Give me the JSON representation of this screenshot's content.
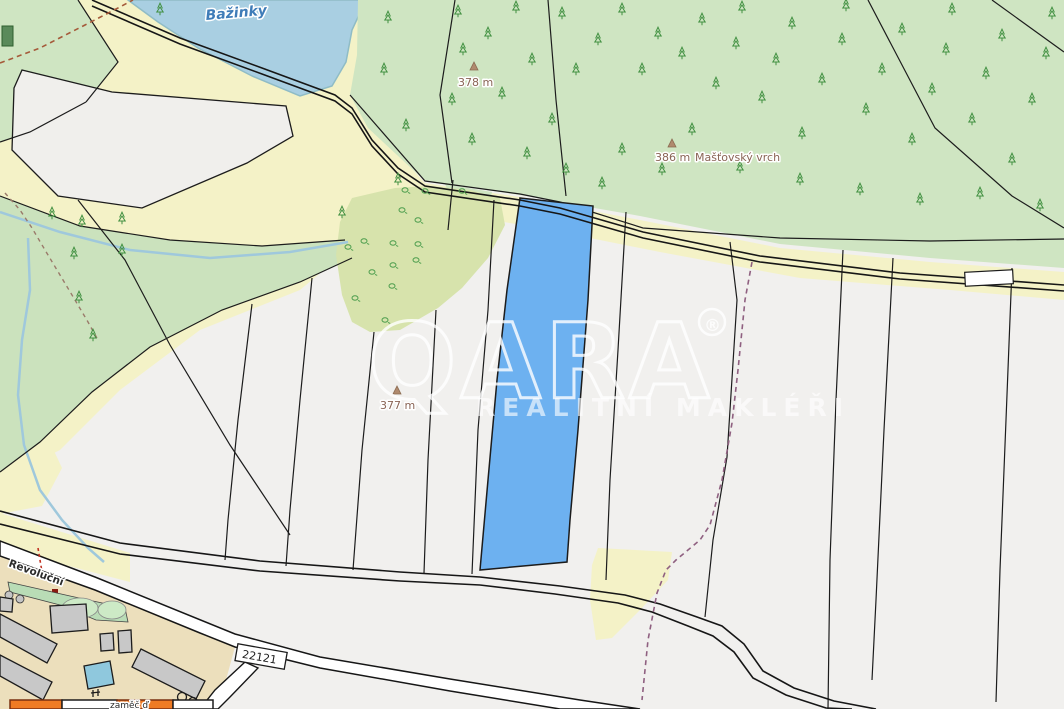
{
  "watermark": {
    "brand": "QARA",
    "registered": "®",
    "tagline": "REALITNÍ MAKLÉŘI"
  },
  "labels": {
    "water_name": "Bažinky",
    "street_name": "Revoluční",
    "road_number": "22121",
    "bottom_partial": "zaměč ď",
    "peak_378": "378 m",
    "peak_386": "386 m",
    "peak_386_name": "Mašťovský vrch",
    "peak_377": "377 m"
  },
  "colors": {
    "parcel_white": "#f1f0ee",
    "field_yellow": "#f4f2c7",
    "urban_tan": "#ecdfbc",
    "forest_green": "#cfe5c2",
    "scrub_olive": "#d7e3ac",
    "water_blue": "#a9cfe2",
    "highlight_parcel_blue": "#6db1f0",
    "building_grey": "#c8c8c8",
    "subject_orange": "#ef7b24",
    "boundary_black": "#1c1c1c",
    "cadastral_dash_mauve": "#8f6080",
    "path_dash_brown": "#a55a3a",
    "peak_label_brown": "#8a6455",
    "water_label_blue": "#3f7cb8"
  },
  "map": {
    "trees": [
      [
        388,
        20
      ],
      [
        384,
        72
      ],
      [
        406,
        128
      ],
      [
        398,
        182
      ],
      [
        458,
        14
      ],
      [
        463,
        52
      ],
      [
        452,
        102
      ],
      [
        472,
        142
      ],
      [
        488,
        36
      ],
      [
        516,
        10
      ],
      [
        502,
        96
      ],
      [
        532,
        62
      ],
      [
        562,
        16
      ],
      [
        576,
        72
      ],
      [
        552,
        122
      ],
      [
        598,
        42
      ],
      [
        622,
        12
      ],
      [
        642,
        72
      ],
      [
        658,
        36
      ],
      [
        682,
        56
      ],
      [
        702,
        22
      ],
      [
        716,
        86
      ],
      [
        736,
        46
      ],
      [
        742,
        10
      ],
      [
        762,
        100
      ],
      [
        776,
        62
      ],
      [
        792,
        26
      ],
      [
        802,
        136
      ],
      [
        822,
        82
      ],
      [
        842,
        42
      ],
      [
        846,
        8
      ],
      [
        866,
        112
      ],
      [
        882,
        72
      ],
      [
        902,
        32
      ],
      [
        912,
        142
      ],
      [
        932,
        92
      ],
      [
        946,
        52
      ],
      [
        952,
        12
      ],
      [
        972,
        122
      ],
      [
        986,
        76
      ],
      [
        1002,
        38
      ],
      [
        1012,
        162
      ],
      [
        1032,
        102
      ],
      [
        1046,
        56
      ],
      [
        1052,
        16
      ],
      [
        622,
        152
      ],
      [
        602,
        186
      ],
      [
        662,
        172
      ],
      [
        692,
        132
      ],
      [
        566,
        172
      ],
      [
        527,
        156
      ],
      [
        740,
        170
      ],
      [
        800,
        182
      ],
      [
        860,
        192
      ],
      [
        920,
        202
      ],
      [
        980,
        196
      ],
      [
        1040,
        208
      ],
      [
        160,
        12
      ],
      [
        52,
        216
      ],
      [
        82,
        224
      ],
      [
        122,
        221
      ],
      [
        74,
        256
      ],
      [
        122,
        253
      ],
      [
        79,
        300
      ],
      [
        93,
        338
      ],
      [
        342,
        215
      ]
    ],
    "bushes": [
      [
        405,
        192
      ],
      [
        425,
        193
      ],
      [
        462,
        193
      ],
      [
        402,
        212
      ],
      [
        418,
        222
      ],
      [
        348,
        249
      ],
      [
        364,
        243
      ],
      [
        393,
        245
      ],
      [
        418,
        246
      ],
      [
        416,
        262
      ],
      [
        393,
        267
      ],
      [
        372,
        274
      ],
      [
        392,
        288
      ],
      [
        385,
        322
      ],
      [
        355,
        300
      ]
    ]
  }
}
